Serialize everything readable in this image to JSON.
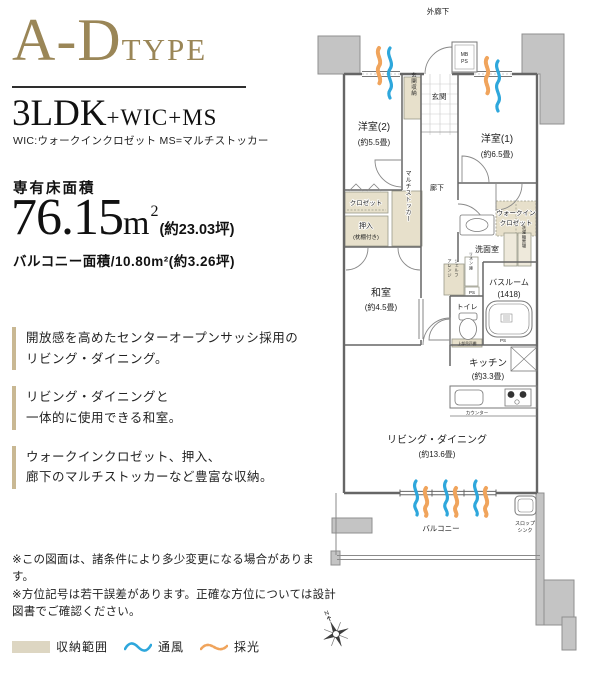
{
  "colors": {
    "accent_gold": "#9a8657",
    "storage_beige": "#e7e0cb",
    "wall_gray": "#c4c4c4",
    "vent_blue": "#2ea7dc",
    "light_orange": "#f0a45c"
  },
  "header": {
    "type_main": "A-D",
    "type_sub": "TYPE"
  },
  "layout": {
    "main": "3LDK",
    "suffix": "+WIC+MS",
    "note": "WIC:ウォークインクロゼット MS=マルチストッカー"
  },
  "area": {
    "label": "専有床面積",
    "value": "76.15",
    "unit": "m",
    "sup": "2",
    "tsubo": "(約23.03坪)",
    "balcony": "バルコニー面積/10.80m²(約3.26坪)"
  },
  "features": [
    "開放感を高めたセンターオープンサッシ採用の\nリビング・ダイニング。",
    "リビング・ダイニングと\n一体的に使用できる和室。",
    "ウォークインクロゼット、押入、\n廊下のマルチストッカーなど豊富な収納。"
  ],
  "notes": [
    "※この図面は、諸条件により多少変更になる場合があります。",
    "※方位記号は若干誤差があります。正確な方位については設計図書でご確認ください。"
  ],
  "legend": {
    "items": [
      {
        "label": "収納範囲"
      },
      {
        "label": "通風"
      },
      {
        "label": "採光"
      }
    ]
  },
  "plan": {
    "outer_corridor": "外廊下",
    "mb": "MB",
    "ps": "PS",
    "entrance": "玄関",
    "entrance_storage": "玄関収納",
    "room2_name": "洋室(2)",
    "room2_size": "(約5.5畳)",
    "room1_name": "洋室(1)",
    "room1_size": "(約6.5畳)",
    "corridor": "廊下",
    "closet": "クロゼット",
    "oshiire_name": "押入",
    "oshiire_size": "(枕棚付き)",
    "multi_stocker": "マルチストッカー",
    "wic_line1": "ウォークイン",
    "wic_line2": "クロゼット",
    "washroom": "洗面室",
    "laundry": "洗濯機置場",
    "linen": "リネン庫",
    "arrange1": "アレンジ",
    "arrange2": "シェルフ",
    "bath_name": "バスルーム",
    "bath_size": "(1418)",
    "toilet": "トイレ",
    "upper_cabinet": "上部吊戸棚",
    "washitsu_name": "和室",
    "washitsu_size": "(約4.5畳)",
    "kitchen_name": "キッチン",
    "kitchen_size": "(約3.3畳)",
    "counter": "カウンター",
    "living_name": "リビング・ダイニング",
    "living_size": "(約13.6畳)",
    "balcony": "バルコニー",
    "slop1": "スロップ",
    "slop2": "シンク",
    "north": "N"
  }
}
